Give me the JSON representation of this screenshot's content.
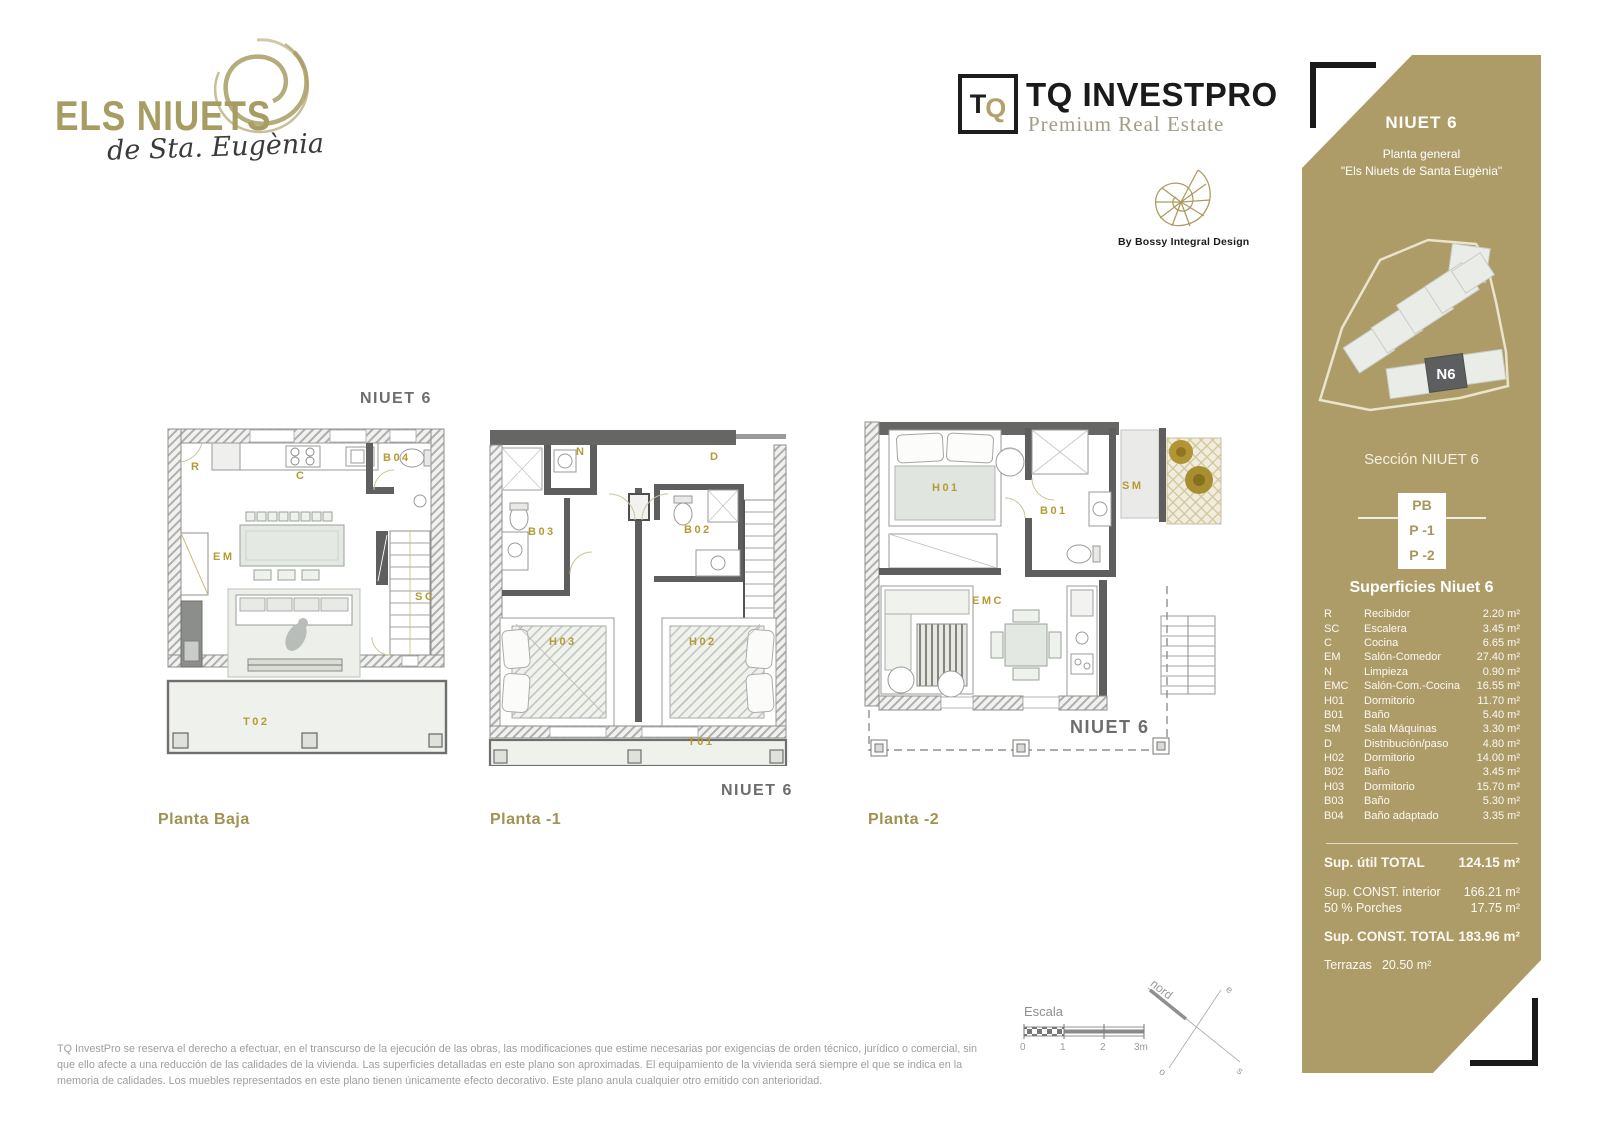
{
  "brand": {
    "name": "ELS NIUETS",
    "script": "de Sta. Eugènia"
  },
  "company": {
    "mark_t": "T",
    "mark_q": "Q",
    "name": "TQ INVEST",
    "name_bold": "PRO",
    "tagline": "Premium Real Estate"
  },
  "designer": {
    "credit": "By Bossy Integral Design"
  },
  "sidebar": {
    "title": "NIUET 6",
    "subtitle1": "Planta general",
    "subtitle2": "\"Els Niuets de Santa Eugènia\"",
    "map_marker": "N6",
    "section_title": "Sección NIUET 6",
    "levels": [
      "PB",
      "P -1",
      "P -2"
    ],
    "surfaces_title": "Superficies Niuet 6",
    "surfaces": [
      {
        "code": "R",
        "name": "Recibidor",
        "area": "2.20 m²"
      },
      {
        "code": "SC",
        "name": "Escalera",
        "area": "3.45 m²"
      },
      {
        "code": "C",
        "name": "Cocina",
        "area": "6.65 m²"
      },
      {
        "code": "EM",
        "name": "Salón-Comedor",
        "area": "27.40 m²"
      },
      {
        "code": "N",
        "name": "Limpieza",
        "area": "0.90 m²"
      },
      {
        "code": "EMC",
        "name": "Salón-Com.-Cocina",
        "area": "16.55 m²"
      },
      {
        "code": "H01",
        "name": "Dormitorio",
        "area": "11.70 m²"
      },
      {
        "code": "B01",
        "name": "Baño",
        "area": "5.40 m²"
      },
      {
        "code": "SM",
        "name": "Sala Máquinas",
        "area": "3.30 m²"
      },
      {
        "code": "D",
        "name": "Distribución/paso",
        "area": "4.80 m²"
      },
      {
        "code": "H02",
        "name": "Dormitorio",
        "area": "14.00 m²"
      },
      {
        "code": "B02",
        "name": "Baño",
        "area": "3.45 m²"
      },
      {
        "code": "H03",
        "name": "Dormitorio",
        "area": "15.70 m²"
      },
      {
        "code": "B03",
        "name": "Baño",
        "area": "5.30 m²"
      },
      {
        "code": "B04",
        "name": "Baño adaptado",
        "area": "3.35 m²"
      }
    ],
    "totals": {
      "util_label": "Sup. útil TOTAL",
      "util_value": "124.15 m²",
      "const_interior_label": "Sup. CONST. interior",
      "const_interior_value": "166.21 m²",
      "porches_label": "50 % Porches",
      "porches_value": "17.75 m²",
      "const_total_label": "Sup. CONST. TOTAL",
      "const_total_value": "183.96 m²",
      "terrazas_label": "Terrazas",
      "terrazas_value": "20.50 m²"
    }
  },
  "plans": [
    {
      "floor_tag": "NIUET 6",
      "label": "Planta Baja",
      "rooms": {
        "r": "R",
        "c": "C",
        "b04": "B04",
        "em": "EM",
        "sc": "SC",
        "t02": "T02"
      }
    },
    {
      "floor_tag": "NIUET 6",
      "label": "Planta -1",
      "rooms": {
        "n": "N",
        "d": "D",
        "b03": "B03",
        "b02": "B02",
        "h03": "H03",
        "h02": "H02",
        "t01": "T01"
      }
    },
    {
      "floor_tag": "NIUET 6",
      "label": "Planta -2",
      "rooms": {
        "h01": "H01",
        "b01": "B01",
        "sm": "SM",
        "emc": "EMC"
      }
    }
  ],
  "footer": {
    "disclaimer": "TQ InvestPro se reserva el derecho a efectuar, en el transcurso de la ejecución de las obras, las modificaciones que estime necesarias por exigencias de orden técnico, jurídico o comercial, sin que ello afecte a una reducción de las calidades de la vivienda. Las superficies detalladas en este plano son aproximadas. El equipamiento de la vivienda será siempre el que se indica en la memoria de calidades. Los muebles representados en este plano tienen únicamente efecto decorativo. Este plano anula cualquier otro emitido con anterioridad.",
    "scale": {
      "label": "Escala",
      "ticks": [
        "0",
        "1",
        "2",
        "3m"
      ]
    },
    "compass": {
      "north": "nord",
      "east": "e",
      "south": "s",
      "west": "o"
    }
  }
}
